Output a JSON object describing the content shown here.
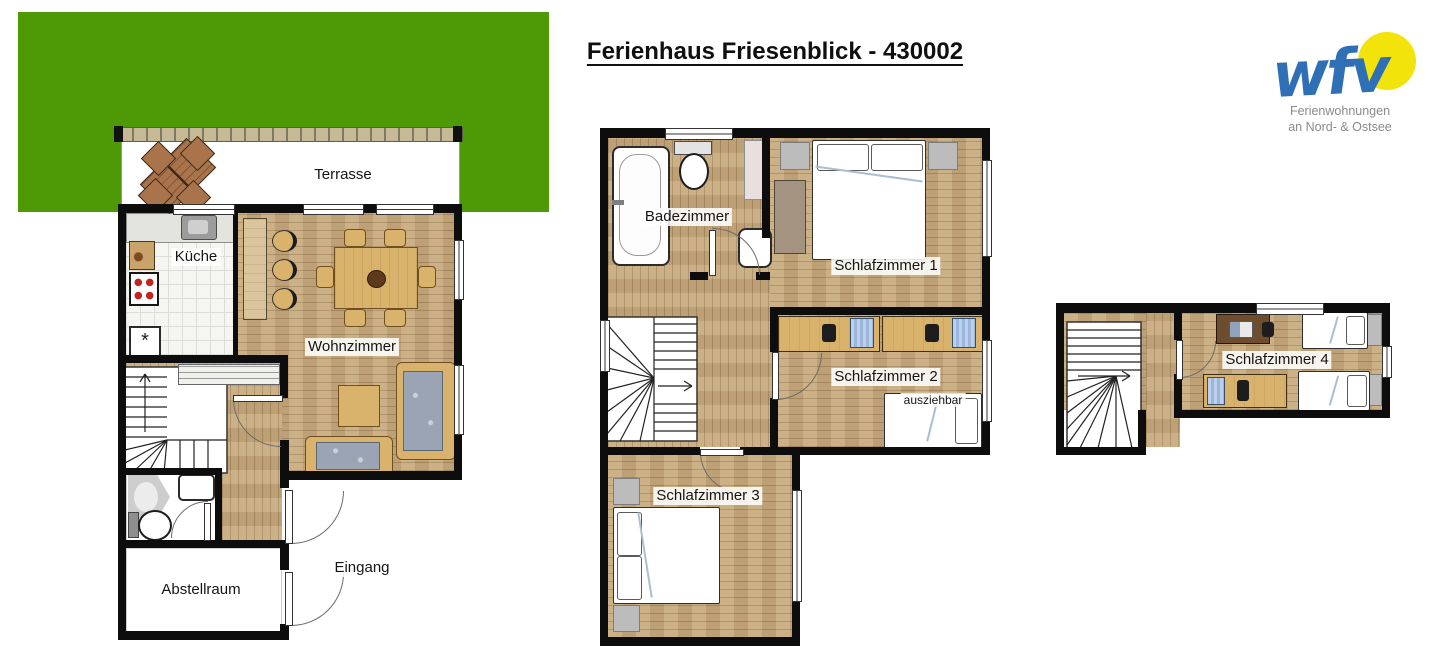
{
  "title": "Ferienhaus Friesenblick - 430002",
  "logo": {
    "acronym": "wfv",
    "line1": "Ferienwohnungen",
    "line2": "an Nord- & Ostsee"
  },
  "rooms": {
    "terrasse": "Terrasse",
    "kueche": "Küche",
    "wohnzimmer": "Wohnzimmer",
    "eingang": "Eingang",
    "abstellraum": "Abstellraum",
    "badezimmer": "Badezimmer",
    "schlafzimmer1": "Schlafzimmer 1",
    "schlafzimmer2": "Schlafzimmer 2",
    "schlafzimmer3": "Schlafzimmer 3",
    "schlafzimmer4": "Schlafzimmer 4"
  },
  "annotations": {
    "ausziehbar": "ausziehbar",
    "freezer_symbol": "*"
  },
  "colors": {
    "garden_green": "#4e9a06",
    "wall_black": "#0d0d0d",
    "wood_floor": "#c8a97c",
    "furniture_wood": "#d9b26b",
    "counter_wood": "#d9c49b",
    "beam_tan": "#c6ba96",
    "cushion_gray": "#9aa4b4",
    "terrace_set_brown": "#a9744b",
    "logo_blue": "#2e6fb5",
    "logo_yellow": "#f2e30b"
  }
}
